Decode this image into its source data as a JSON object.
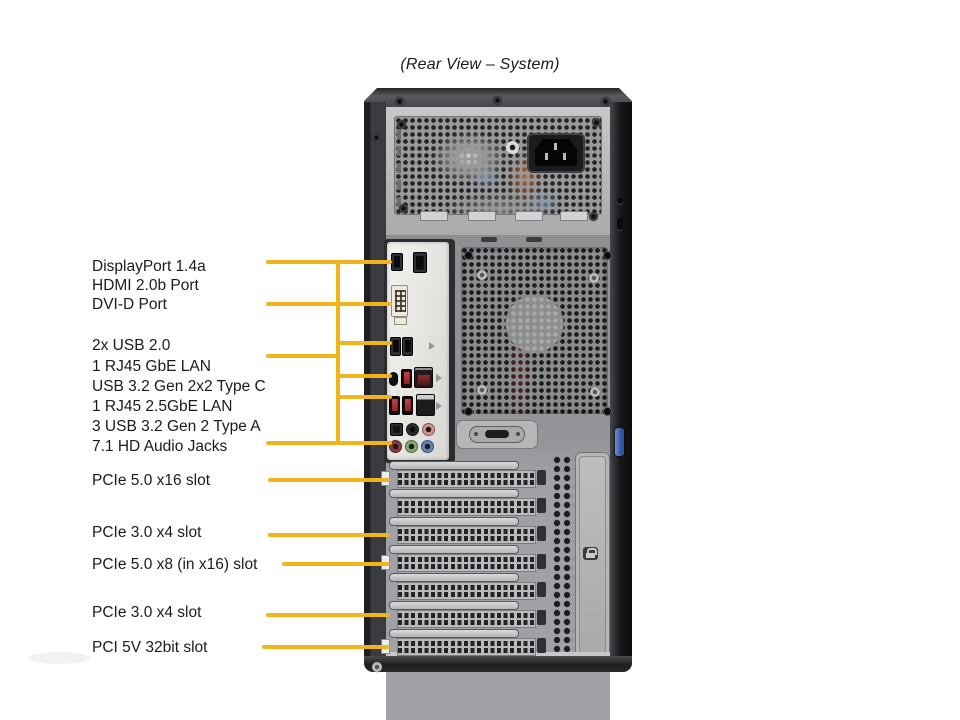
{
  "title": "(Rear View – System)",
  "colors": {
    "leader_line": "#F2B31D",
    "label_text": "#1B1B1B",
    "background": "#FFFFFF",
    "thumbscrew_blue": "#4A6FBE"
  },
  "figure": {
    "labels": [
      {
        "id": "displayport",
        "text": "DisplayPort 1.4a",
        "x": 92,
        "y": 257
      },
      {
        "id": "hdmi",
        "text": "HDMI 2.0b Port",
        "x": 92,
        "y": 276
      },
      {
        "id": "dvi",
        "text": "DVI-D Port",
        "x": 92,
        "y": 295
      },
      {
        "id": "usb20",
        "text": "2x USB 2.0",
        "x": 92,
        "y": 336
      },
      {
        "id": "lan-gbe",
        "text": "1 RJ45 GbE LAN",
        "x": 92,
        "y": 357
      },
      {
        "id": "usb32-typec",
        "text": "USB 3.2 Gen 2x2 Type C",
        "x": 92,
        "y": 377
      },
      {
        "id": "lan-25gbe",
        "text": "1 RJ45 2.5GbE LAN",
        "x": 92,
        "y": 397
      },
      {
        "id": "usb32-typea",
        "text": "3 USB 3.2 Gen 2 Type A",
        "x": 92,
        "y": 417
      },
      {
        "id": "audio",
        "text": "7.1 HD Audio Jacks",
        "x": 92,
        "y": 437
      },
      {
        "id": "pcie5-x16",
        "text": "PCIe 5.0 x16 slot",
        "x": 92,
        "y": 471
      },
      {
        "id": "pcie3-x4-a",
        "text": "PCIe 3.0 x4 slot",
        "x": 92,
        "y": 523
      },
      {
        "id": "pcie5-x8",
        "text": "PCIe 5.0 x8 (in x16) slot",
        "x": 92,
        "y": 555
      },
      {
        "id": "pcie3-x4-b",
        "text": "PCIe 3.0 x4 slot",
        "x": 92,
        "y": 603
      },
      {
        "id": "pci-5v",
        "text": "PCI 5V 32bit slot",
        "x": 92,
        "y": 638
      }
    ],
    "leader_lines": [
      {
        "dir": "h",
        "x": 266,
        "y": 262,
        "len": 126
      },
      {
        "dir": "h",
        "x": 266,
        "y": 304,
        "len": 126
      },
      {
        "dir": "v",
        "x": 338,
        "y": 260,
        "len": 185
      },
      {
        "dir": "h",
        "x": 266,
        "y": 356,
        "len": 74
      },
      {
        "dir": "h",
        "x": 338,
        "y": 343,
        "len": 54
      },
      {
        "dir": "h",
        "x": 338,
        "y": 376,
        "len": 54
      },
      {
        "dir": "h",
        "x": 338,
        "y": 397,
        "len": 54
      },
      {
        "dir": "h",
        "x": 266,
        "y": 443,
        "len": 126
      },
      {
        "dir": "h",
        "x": 268,
        "y": 480,
        "len": 122
      },
      {
        "dir": "h",
        "x": 268,
        "y": 535,
        "len": 122
      },
      {
        "dir": "h",
        "x": 282,
        "y": 564,
        "len": 108
      },
      {
        "dir": "h",
        "x": 266,
        "y": 615,
        "len": 124
      },
      {
        "dir": "h",
        "x": 262,
        "y": 647,
        "len": 128
      }
    ],
    "ports": [
      {
        "name": "hdmi-port",
        "x": 391,
        "y": 253,
        "w": 12,
        "h": 18,
        "cls": "p-black"
      },
      {
        "name": "displayport-port",
        "x": 413,
        "y": 252,
        "w": 14,
        "h": 21,
        "cls": "p-black"
      },
      {
        "name": "dvi-d-port",
        "x": 391,
        "y": 285,
        "w": 17,
        "h": 32,
        "cls": "p-dvi"
      },
      {
        "name": "usb2-port-1",
        "x": 390,
        "y": 337,
        "w": 11,
        "h": 19,
        "cls": "p-black"
      },
      {
        "name": "usb2-port-2",
        "x": 402,
        "y": 337,
        "w": 11,
        "h": 19,
        "cls": "p-black"
      },
      {
        "name": "usb-c-port",
        "x": 389,
        "y": 372,
        "w": 9,
        "h": 14,
        "cls": "p-usbc"
      },
      {
        "name": "usb32-port-1",
        "x": 401,
        "y": 369,
        "w": 11,
        "h": 19,
        "cls": "p-red"
      },
      {
        "name": "lan-2-5gbe-port",
        "x": 414,
        "y": 367,
        "w": 19,
        "h": 21,
        "cls": "p-lan-red"
      },
      {
        "name": "usb32-port-2",
        "x": 389,
        "y": 396,
        "w": 11,
        "h": 19,
        "cls": "p-red"
      },
      {
        "name": "usb32-port-3",
        "x": 402,
        "y": 396,
        "w": 11,
        "h": 19,
        "cls": "p-red"
      },
      {
        "name": "lan-gbe-port",
        "x": 416,
        "y": 394,
        "w": 19,
        "h": 22,
        "cls": "p-lan"
      },
      {
        "name": "optical-audio-jack",
        "x": 390,
        "y": 423,
        "w": 13,
        "h": 13,
        "cls": "p-optical"
      },
      {
        "name": "audio-jack-black",
        "x": 406,
        "y": 423,
        "w": 13,
        "h": 13,
        "cls": "p-jack j-black"
      },
      {
        "name": "audio-jack-pink",
        "x": 422,
        "y": 423,
        "w": 13,
        "h": 13,
        "cls": "p-jack j-pink"
      },
      {
        "name": "audio-jack-red",
        "x": 389,
        "y": 440,
        "w": 13,
        "h": 13,
        "cls": "p-jack j-red"
      },
      {
        "name": "audio-jack-green",
        "x": 405,
        "y": 440,
        "w": 13,
        "h": 13,
        "cls": "p-jack j-green"
      },
      {
        "name": "audio-jack-blue",
        "x": 421,
        "y": 440,
        "w": 13,
        "h": 13,
        "cls": "p-jack j-blue"
      }
    ],
    "usb_marks": [
      {
        "x": 429,
        "y": 342
      },
      {
        "x": 436,
        "y": 374
      },
      {
        "x": 436,
        "y": 402
      }
    ],
    "slots": [
      {
        "tab": true
      },
      {
        "tab": false
      },
      {
        "tab": false
      },
      {
        "tab": true
      },
      {
        "tab": false
      },
      {
        "tab": false
      },
      {
        "tab": true
      }
    ],
    "slot_layout": {
      "first_top": 461,
      "pitch": 28
    },
    "screws": [
      {
        "x": 395,
        "y": 97,
        "v": "dark"
      },
      {
        "x": 493,
        "y": 96,
        "v": "dark"
      },
      {
        "x": 601,
        "y": 97,
        "v": "dark"
      },
      {
        "x": 372,
        "y": 133,
        "v": "dark"
      },
      {
        "x": 372,
        "y": 662,
        "v": "light"
      },
      {
        "x": 397,
        "y": 120,
        "v": "dark"
      },
      {
        "x": 592,
        "y": 118,
        "v": "dark"
      },
      {
        "x": 399,
        "y": 204,
        "v": "dark"
      },
      {
        "x": 589,
        "y": 212,
        "v": "dark"
      },
      {
        "x": 506,
        "y": 141,
        "v": "washer"
      },
      {
        "x": 477,
        "y": 270,
        "v": "light"
      },
      {
        "x": 589,
        "y": 273,
        "v": "light"
      },
      {
        "x": 477,
        "y": 385,
        "v": "light"
      },
      {
        "x": 590,
        "y": 387,
        "v": "light"
      },
      {
        "x": 465,
        "y": 252,
        "v": "hole"
      },
      {
        "x": 604,
        "y": 252,
        "v": "hole"
      },
      {
        "x": 465,
        "y": 408,
        "v": "hole"
      },
      {
        "x": 604,
        "y": 408,
        "v": "hole"
      }
    ]
  }
}
